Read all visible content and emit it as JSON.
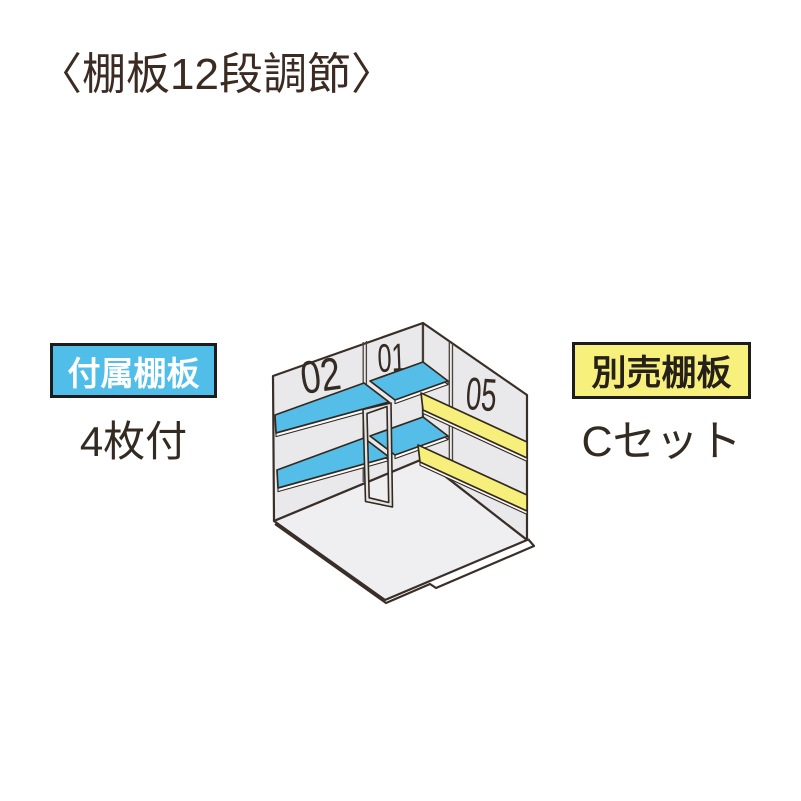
{
  "title": {
    "text": "〈棚板12段調節〉"
  },
  "callouts": {
    "included": {
      "label": "付属棚板",
      "value": "4枚付",
      "bg_color": "#50bee9",
      "text_color": "#ffffff"
    },
    "optional": {
      "label": "別売棚板",
      "value": "Cセット",
      "bg_color": "#f7f07d",
      "text_color": "#26201b"
    }
  },
  "diagram": {
    "description": "Isometric interior corner view of storage shed with two rows of shelves on each wall",
    "shelf_labels": [
      {
        "text": "02",
        "wall": "left",
        "shelf_color": "#55bee8"
      },
      {
        "text": "01",
        "wall": "left-corner",
        "shelf_color": "#55bee8"
      },
      {
        "text": "05",
        "wall": "right",
        "shelf_color": "#f6ef7c"
      }
    ],
    "colors": {
      "included_shelf_blue": "#55bee8",
      "optional_shelf_yellow": "#f6ef7c",
      "wall_gray": "#e9e9eb",
      "floor_gray": "#efeff1",
      "outline": "#3a2f28"
    }
  }
}
